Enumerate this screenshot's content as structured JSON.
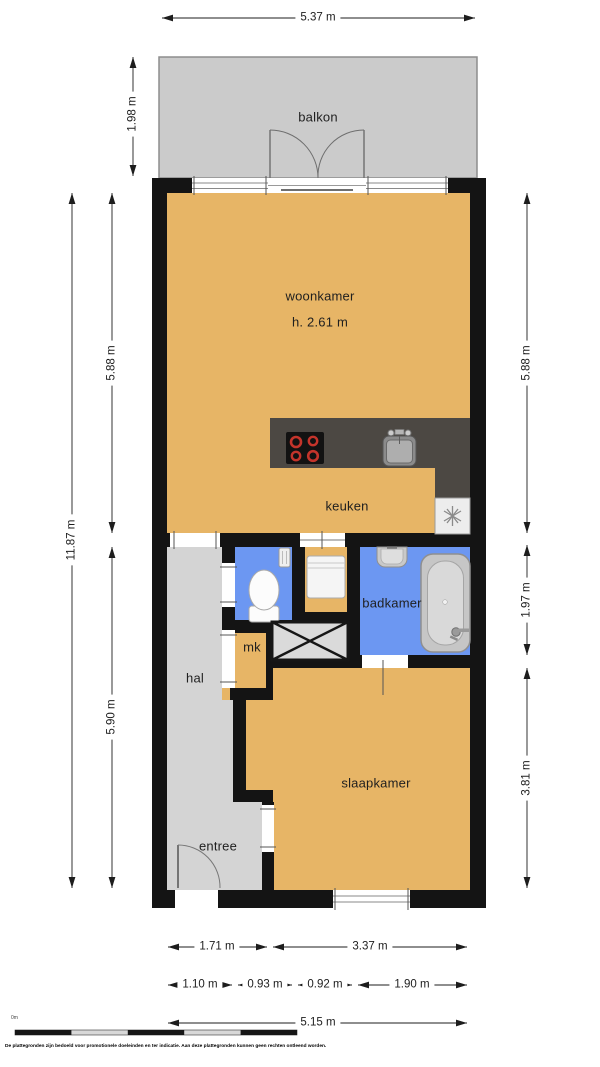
{
  "plan": {
    "rooms": {
      "balkon": "balkon",
      "woonkamer": "woonkamer",
      "woonkamer_ceiling_height": "h. 2.61 m",
      "keuken": "keuken",
      "badkamer": "badkamer",
      "mk": "mk",
      "hal": "hal",
      "slaapkamer": "slaapkamer",
      "entree": "entree"
    },
    "dimensions": {
      "balcony_width_top": "5.37 m",
      "balcony_depth_left": "1.98 m",
      "total_depth_left": "11.87 m",
      "living_depth_left": "5.88 m",
      "rear_depth_left": "5.90 m",
      "living_depth_right": "5.88 m",
      "bathroom_depth_right": "1.97 m",
      "bedroom_depth_right": "3.81 m",
      "bottom_row_inner": [
        "1.71 m",
        "3.37 m"
      ],
      "bottom_row_detail": [
        "1.10 m",
        "0.93 m",
        "0.92 m",
        "1.90 m"
      ],
      "bottom_total_width": "5.15 m"
    },
    "scale_bar_origin": "0m",
    "disclaimer": "De plattegronden zijn bedoeld voor promotionele doeleinden en ter indicatie. Aan deze plattegronden kunnen geen rechten ontleend worden.",
    "colors": {
      "floor_dry": "#E7B566",
      "floor_wet": "#6C97F2",
      "floor_hall": "#D4D4D4",
      "balcony": "#CBCBCB",
      "walls": "#141414",
      "counter": "#4C4843"
    }
  }
}
